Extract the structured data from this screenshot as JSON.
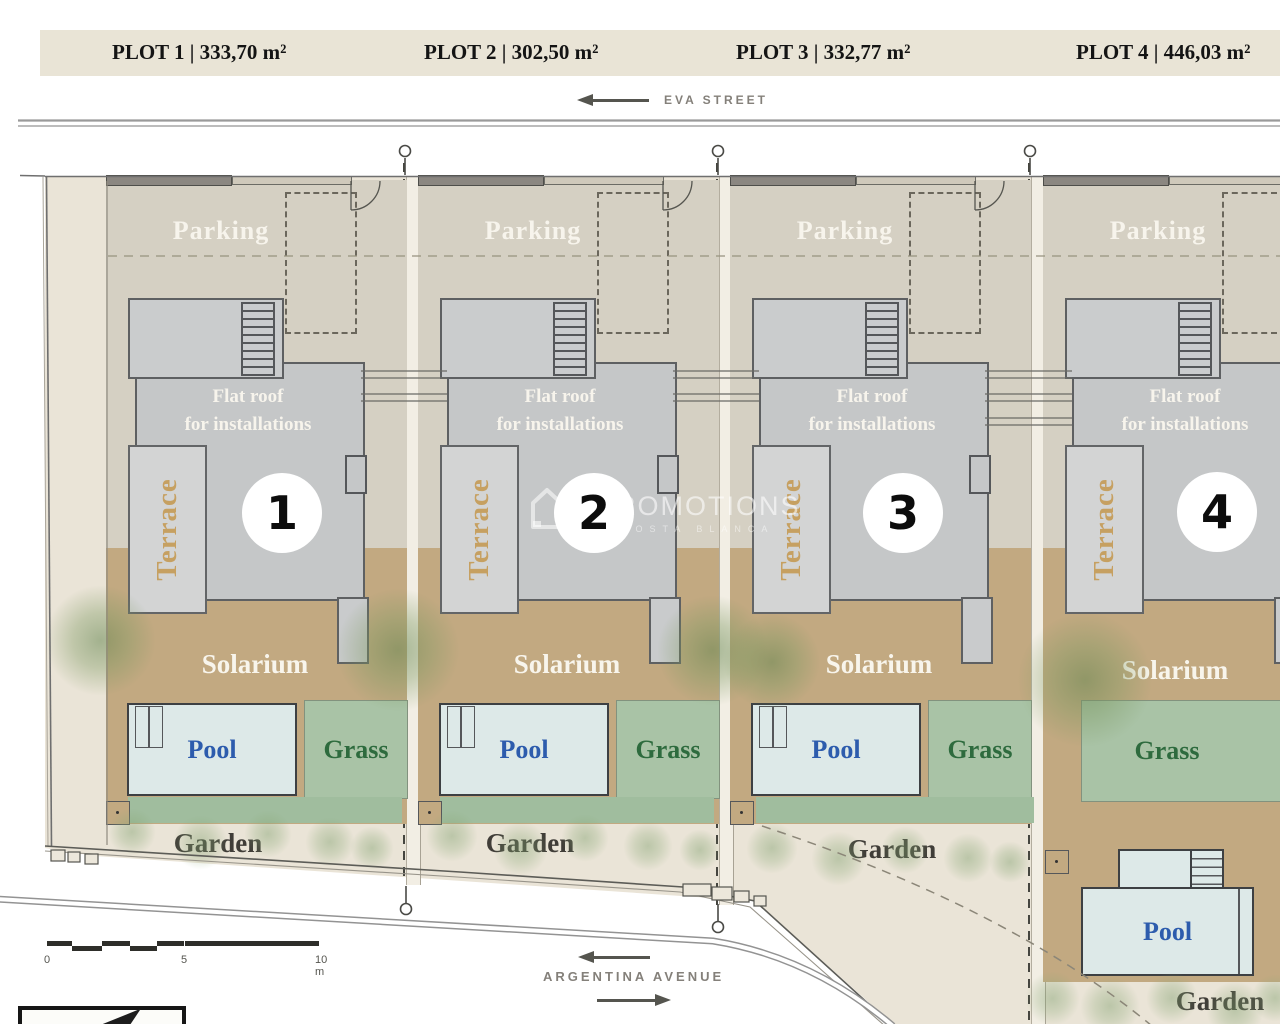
{
  "header": {
    "plot_labels": [
      "PLOT 1 | 333,70 m²",
      "PLOT 2 | 302,50 m²",
      "PLOT 3 | 332,77 m²",
      "PLOT 4 | 446,03 m²"
    ]
  },
  "streets": {
    "top": "EVA STREET",
    "bottom": "ARGENTINA AVENUE"
  },
  "plots": [
    {
      "number": "1",
      "parking": "Parking",
      "flat_roof_line1": "Flat roof",
      "flat_roof_line2": "for installations",
      "terrace": "Terrace",
      "solarium": "Solarium",
      "pool": "Pool",
      "grass": "Grass",
      "garden": "Garden"
    },
    {
      "number": "2",
      "parking": "Parking",
      "flat_roof_line1": "Flat roof",
      "flat_roof_line2": "for installations",
      "terrace": "Terrace",
      "solarium": "Solarium",
      "pool": "Pool",
      "grass": "Grass",
      "garden": "Garden"
    },
    {
      "number": "3",
      "parking": "Parking",
      "flat_roof_line1": "Flat roof",
      "flat_roof_line2": "for installations",
      "terrace": "Terrace",
      "solarium": "Solarium",
      "pool": "Pool",
      "grass": "Grass",
      "garden": "Garden"
    },
    {
      "number": "4",
      "parking": "Parking",
      "flat_roof_line1": "Flat roof",
      "flat_roof_line2": "for installations",
      "terrace": "Terrace",
      "solarium": "Solarium",
      "pool": "Pool",
      "grass": "Grass",
      "garden": "Garden"
    }
  ],
  "watermark": {
    "name": "PROMOTIONS",
    "subtitle": "COSTA BLANCA"
  },
  "scale_bar": {
    "start": "0",
    "mid": "5",
    "end": "10 m"
  },
  "colors": {
    "site_base": "#eae4d7",
    "parking": "#d5d0c3",
    "solarium_tan": "#c2a981",
    "building_gray": "#c5c7c8",
    "pool_fill": "#dde9e8",
    "pool_text": "#2d5cad",
    "grass_fill": "#a9c3a6",
    "grass_text": "#2e6b3e",
    "terrace_text": "#c59c58",
    "header_bar": "#e9e4d6"
  }
}
